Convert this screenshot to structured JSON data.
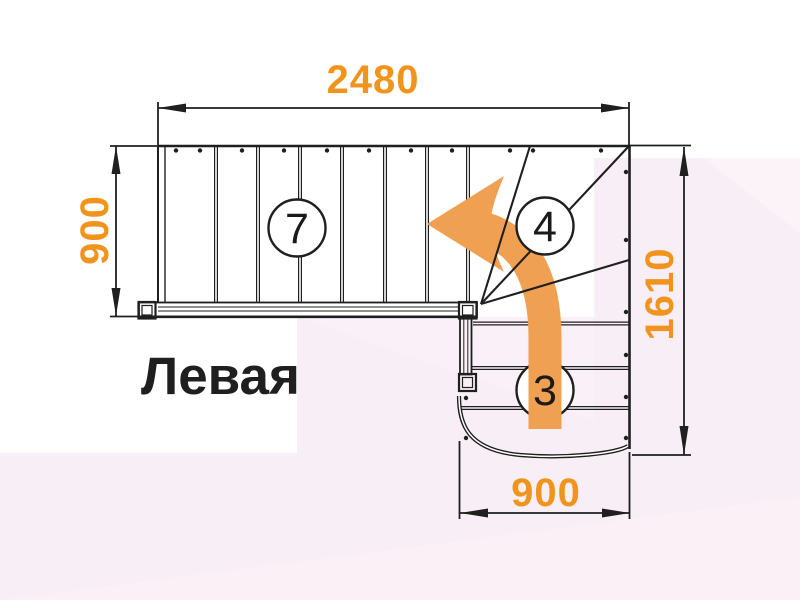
{
  "diagram": {
    "title": "Левая",
    "dimensions": {
      "top_width": "2480",
      "left_height": "900",
      "right_height": "1610",
      "bottom_width": "900"
    },
    "step_counts": {
      "upper_flight": "7",
      "winder": "4",
      "lower_flight": "3"
    },
    "icons": {
      "turn_arrow": "curved-turn-left-arrow"
    }
  },
  "colors": {
    "dimension_text": "#F0941E",
    "turn_arrow": "#F0A052",
    "linework": "#1F1F1F",
    "background_pink": "#F8EEF5",
    "background_pink_light": "#FBF3F8",
    "background_pink_mid": "#FAF0F6"
  }
}
